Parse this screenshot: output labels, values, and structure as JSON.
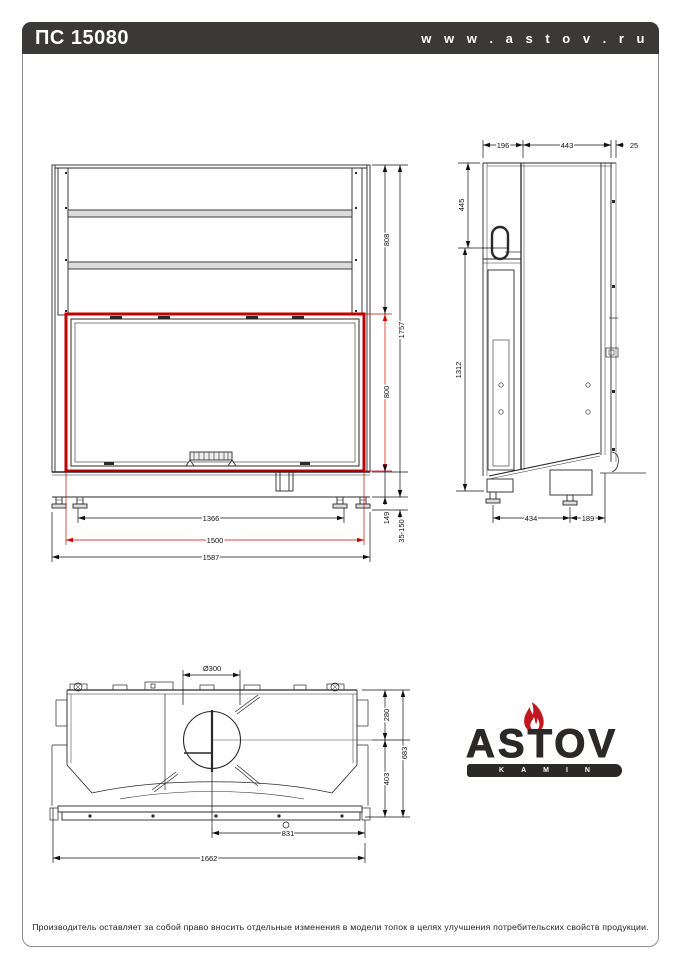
{
  "header": {
    "model": "ПС 15080",
    "website": "w w w . a s t o v . r u"
  },
  "front_view": {
    "upper_section_height": "808",
    "total_height": "1757",
    "glass_height": "800",
    "base_height": "149",
    "leg_adjust_range": "35-150",
    "feet_spacing": "1366",
    "glass_width": "1500",
    "total_width": "1587"
  },
  "side_view": {
    "rear_depth": "196",
    "body_depth": "443",
    "frame_depth": "25",
    "top_to_handle": "445",
    "body_height": "1312",
    "feet_spacing": "434",
    "front_overhang": "189"
  },
  "top_view": {
    "flue_diameter": "Ø300",
    "flue_center_from_rear": "280",
    "flue_center_to_front": "403",
    "total_depth": "683",
    "flue_center_to_right": "831",
    "total_width": "1662"
  },
  "logo": {
    "brand": "ASTOV",
    "sub": "KAMIN"
  },
  "footer": {
    "disclaimer": "Производитель оставляет за собой право вносить отдельные изменения в модели топок в целях улучшения потребительских свойств продукции."
  },
  "colors": {
    "accent_red": "#c00000",
    "ink": "#222222",
    "header_bg": "#3a3938"
  }
}
